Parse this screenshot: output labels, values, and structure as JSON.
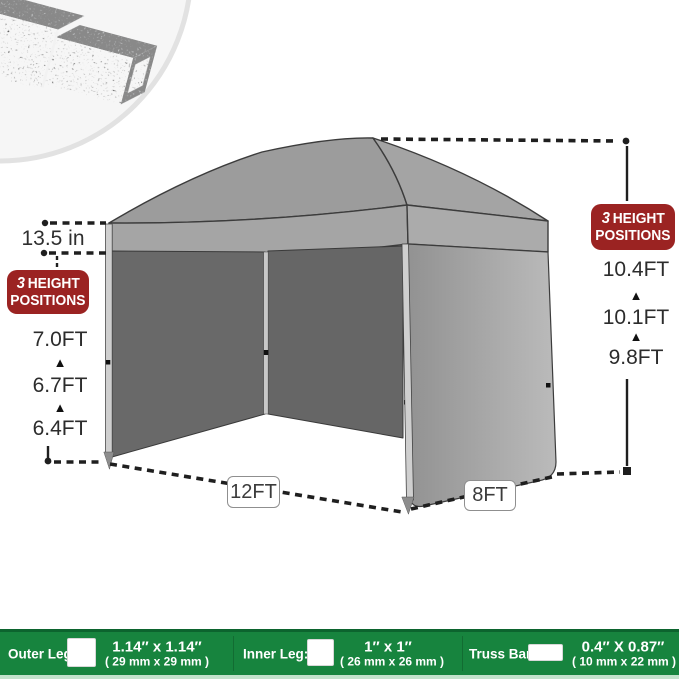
{
  "annotations": {
    "valance_height": "13.5 in",
    "arrow": "▲",
    "left_heights": [
      "7.0FT",
      "6.7FT",
      "6.4FT"
    ],
    "right_heights": [
      "10.4FT",
      "10.1FT",
      "9.8FT"
    ],
    "width_label": "12FT",
    "depth_label": "8FT",
    "badge": {
      "number": "3",
      "word1": "HEIGHT",
      "word2": "POSITIONS"
    }
  },
  "spec_bar": {
    "items": [
      {
        "label": "Outer Leg:",
        "icon": "square-tube-cross-section-icon",
        "size_in": "1.14″ x 1.14″",
        "size_mm": "( 29 mm x 29 mm )"
      },
      {
        "label": "Inner Leg:",
        "icon": "square-tube-cross-section-icon",
        "size_in": "1″ x 1″",
        "size_mm": "( 26 mm x 26 mm )"
      },
      {
        "label": "Truss Bar:",
        "icon": "rect-tube-cross-section-icon",
        "size_in": "0.4″ X 0.87″",
        "size_mm": "( 10 mm x 22 mm )"
      }
    ]
  },
  "hero": {
    "icon": "nested-steel-square-tubes-photo"
  },
  "colors": {
    "badge_red": "#9b2322",
    "bar_green": "#17843e",
    "bar_green_dark": "#0c642e",
    "bar_green_light": "#c2e2cb",
    "roof_gray": "#9c9c9c",
    "valance_gray": "#a5a5a5",
    "interior_gray": "#686868",
    "side_wall_gray": "#b2b2b2",
    "leg_gray": "#cfcfcf",
    "line_color": "#1f1f1f"
  }
}
